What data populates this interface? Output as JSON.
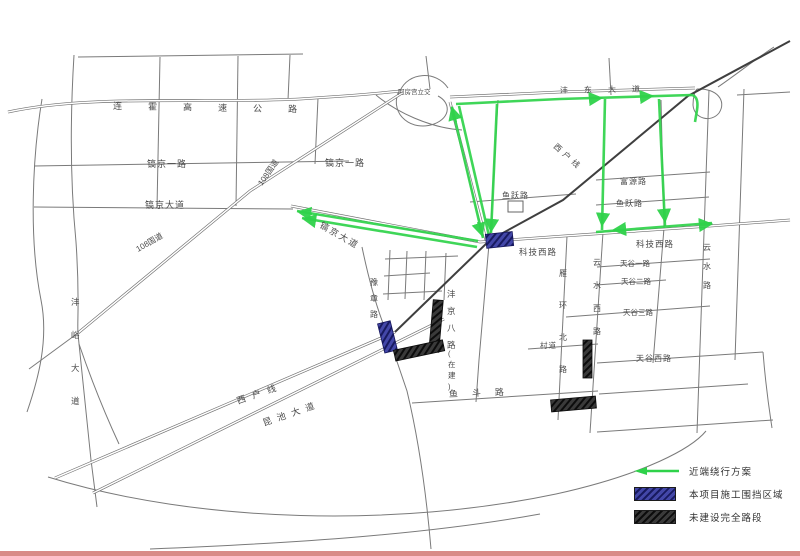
{
  "legend": {
    "detour": "近端绕行方案",
    "construction": "本项目施工围挡区域",
    "unbuilt": "未建设完全路段"
  },
  "colors": {
    "detour_green": "#2fd24a",
    "construction_blue": "#4347a8",
    "unbuilt_dark": "#2f2f2f",
    "road_gray": "#7a7a7a",
    "accent_bar": "#d98b88"
  },
  "map": {
    "labels": [
      {
        "text": "连霍高速公路",
        "x": 113,
        "y": 109,
        "size": 9,
        "ls": 26,
        "rot": 1
      },
      {
        "text": "阿房宫立交",
        "x": 398,
        "y": 94,
        "size": 6.5,
        "ls": 0
      },
      {
        "text": "沣东大道",
        "x": 560,
        "y": 93,
        "size": 8,
        "ls": 16,
        "rot": -1
      },
      {
        "text": "镐京一路",
        "x": 147,
        "y": 167,
        "size": 9,
        "ls": 1
      },
      {
        "text": "镐京一路",
        "x": 325,
        "y": 166,
        "size": 9,
        "ls": 1
      },
      {
        "text": "镐京大道",
        "x": 145,
        "y": 208,
        "size": 9,
        "ls": 1
      },
      {
        "text": "108国道",
        "x": 262,
        "y": 186,
        "size": 8,
        "rot": -55
      },
      {
        "text": "108国道",
        "x": 138,
        "y": 252,
        "size": 8,
        "rot": -30
      },
      {
        "text": "镐京大道",
        "x": 319,
        "y": 227,
        "size": 9,
        "rot": 30,
        "ls": 2
      },
      {
        "text": "西户线",
        "x": 553,
        "y": 147,
        "size": 8,
        "rot": 42,
        "ls": 4
      },
      {
        "text": "科技西路",
        "x": 519,
        "y": 255,
        "size": 8.5,
        "ls": 1
      },
      {
        "text": "科技西路",
        "x": 636,
        "y": 247,
        "size": 8.5,
        "ls": 1
      },
      {
        "text": "鱼跃路",
        "x": 502,
        "y": 198,
        "size": 8,
        "ls": 1
      },
      {
        "text": "鱼跃路",
        "x": 616,
        "y": 206,
        "size": 8,
        "ls": 1
      },
      {
        "text": "富源路",
        "x": 620,
        "y": 184,
        "size": 8,
        "ls": 1
      },
      {
        "text": "天谷一路",
        "x": 620,
        "y": 266,
        "size": 7.5,
        "ls": 0
      },
      {
        "text": "天谷二路",
        "x": 621,
        "y": 284,
        "size": 7.5,
        "ls": 0
      },
      {
        "text": "天谷三路",
        "x": 623,
        "y": 315,
        "size": 7.5,
        "ls": 0
      },
      {
        "text": "天谷西路",
        "x": 636,
        "y": 361,
        "size": 8,
        "ls": 1
      },
      {
        "text": "云水西路",
        "x": 593,
        "y": 265,
        "size": 8,
        "vertical": true,
        "step": 23
      },
      {
        "text": "云水路",
        "x": 703,
        "y": 250,
        "size": 8,
        "vertical": true,
        "step": 19
      },
      {
        "text": "雁环北路",
        "x": 559,
        "y": 276,
        "size": 8,
        "vertical": true,
        "step": 32
      },
      {
        "text": "村道",
        "x": 540,
        "y": 348,
        "size": 7.5,
        "ls": 1
      },
      {
        "text": "豫章路",
        "x": 370,
        "y": 285,
        "size": 8,
        "vertical": true,
        "step": 16
      },
      {
        "text": "沣京八路",
        "x": 447,
        "y": 297,
        "size": 8.5,
        "vertical": true,
        "step": 17
      },
      {
        "text": "(在建)",
        "x": 448,
        "y": 356,
        "size": 7.5,
        "vertical": true,
        "step": 11
      },
      {
        "text": "沣峪大道",
        "x": 71,
        "y": 305,
        "size": 8.5,
        "vertical": true,
        "step": 33
      },
      {
        "text": "西户线",
        "x": 238,
        "y": 404,
        "size": 9,
        "rot": -19,
        "ls": 7
      },
      {
        "text": "昆池大道",
        "x": 264,
        "y": 426,
        "size": 9,
        "rot": -19,
        "ls": 6
      },
      {
        "text": "鱼斗路",
        "x": 449,
        "y": 397,
        "size": 9,
        "rot": -2,
        "ls": 14
      }
    ]
  }
}
